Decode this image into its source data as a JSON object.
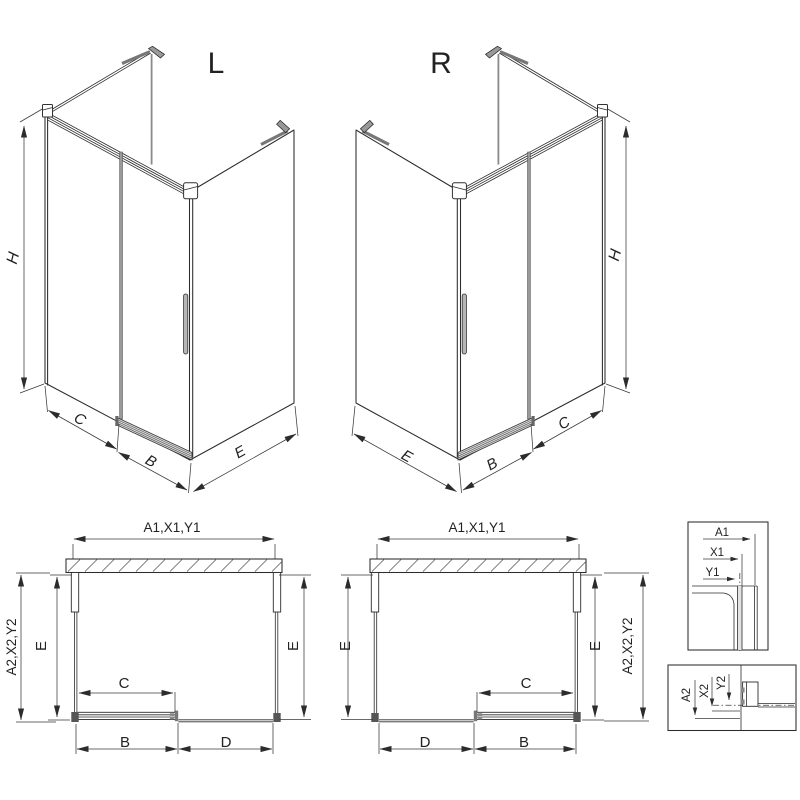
{
  "drawing_title": "shower-enclosure-technical-drawing",
  "colors": {
    "line": "#2c2c2c",
    "dim_line": "#3a3a3a",
    "profile_gray": "#999999",
    "handle_gray": "#b5b5b5",
    "background": "#ffffff"
  },
  "iso_left": {
    "title": "L",
    "height_dim": "H",
    "fixed_dim": "C",
    "door_dim": "B",
    "side_dim": "E"
  },
  "iso_right": {
    "title": "R",
    "height_dim": "H",
    "fixed_dim": "C",
    "door_dim": "B",
    "side_dim": "E"
  },
  "plan_left": {
    "width_dim": "A1,X1,Y1",
    "outer_dim": "A2,X2,Y2",
    "depth_left": "E",
    "depth_right": "E",
    "door_dim": "C",
    "bottom_left": "B",
    "bottom_right": "D"
  },
  "plan_right": {
    "width_dim": "A1,X1,Y1",
    "outer_dim": "A2,X2,Y2",
    "depth_left": "E",
    "depth_right": "E",
    "door_dim": "C",
    "bottom_left": "D",
    "bottom_right": "B"
  },
  "detail_top": {
    "dim_a": "A1",
    "dim_x": "X1",
    "dim_y": "Y1"
  },
  "detail_bottom": {
    "dim_a": "A2",
    "dim_x": "X2",
    "dim_y": "Y2"
  }
}
